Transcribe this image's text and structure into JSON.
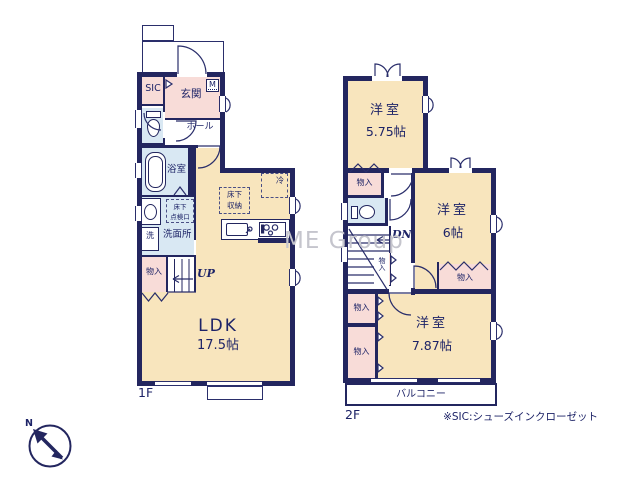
{
  "watermark": "ME Group",
  "note": "※SIC:シューズインクローゼット",
  "compass": {
    "north_label": "N"
  },
  "floor1": {
    "floor_label": "1F",
    "sic_label": "SIC",
    "genkan_label": "玄関",
    "meter_label": "M",
    "hall_label": "ホール",
    "bath_label": "浴室",
    "washroom_label": "洗面所",
    "laundry_label": "洗",
    "closet_label": "物入",
    "stairs_label": "UP",
    "ldk_name": "LDK",
    "ldk_size": "17.5帖",
    "underfloor_storage_line1": "床下",
    "underfloor_storage_line2": "収納",
    "underfloor_hatch_line1": "床下",
    "underfloor_hatch_line2": "点検口",
    "fridge_label": "冷"
  },
  "floor2": {
    "floor_label": "2F",
    "room1_name": "洋室",
    "room1_size": "5.75帖",
    "room2_name": "洋室",
    "room2_size": "6帖",
    "room3_name": "洋室",
    "room3_size": "7.87帖",
    "closet_label": "物入",
    "stairs_label": "DN",
    "balcony_label": "バルコニー"
  },
  "colors": {
    "wall_navy": "#23265f",
    "room_beige": "#f8e5bd",
    "closet_pink": "#f8dcd8",
    "wet_area_blue": "#d9e8f3",
    "text_navy": "#1d2367",
    "watermark_gray": "#c5c5cd"
  }
}
